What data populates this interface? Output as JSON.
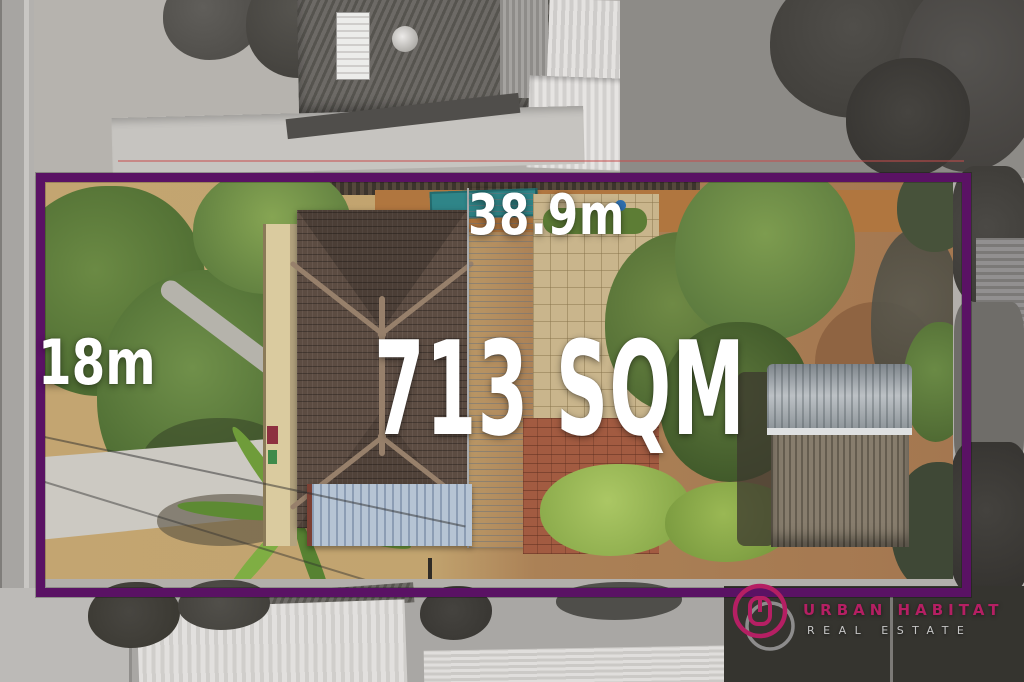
{
  "property_overlay": {
    "frontage_label": "38.9m",
    "side_label": "18m",
    "area_label": "713 SQM"
  },
  "branding": {
    "brand_name": "URBAN HABITAT",
    "brand_subtitle": "REAL ESTATE",
    "logo_icon": "overlapping-rings-logo"
  },
  "colors": {
    "boundary_purple": "#5a1264",
    "label_white": "#ffffff",
    "brand_magenta": "#b51f63",
    "brand_subtitle_gray": "#c6c6c6"
  }
}
